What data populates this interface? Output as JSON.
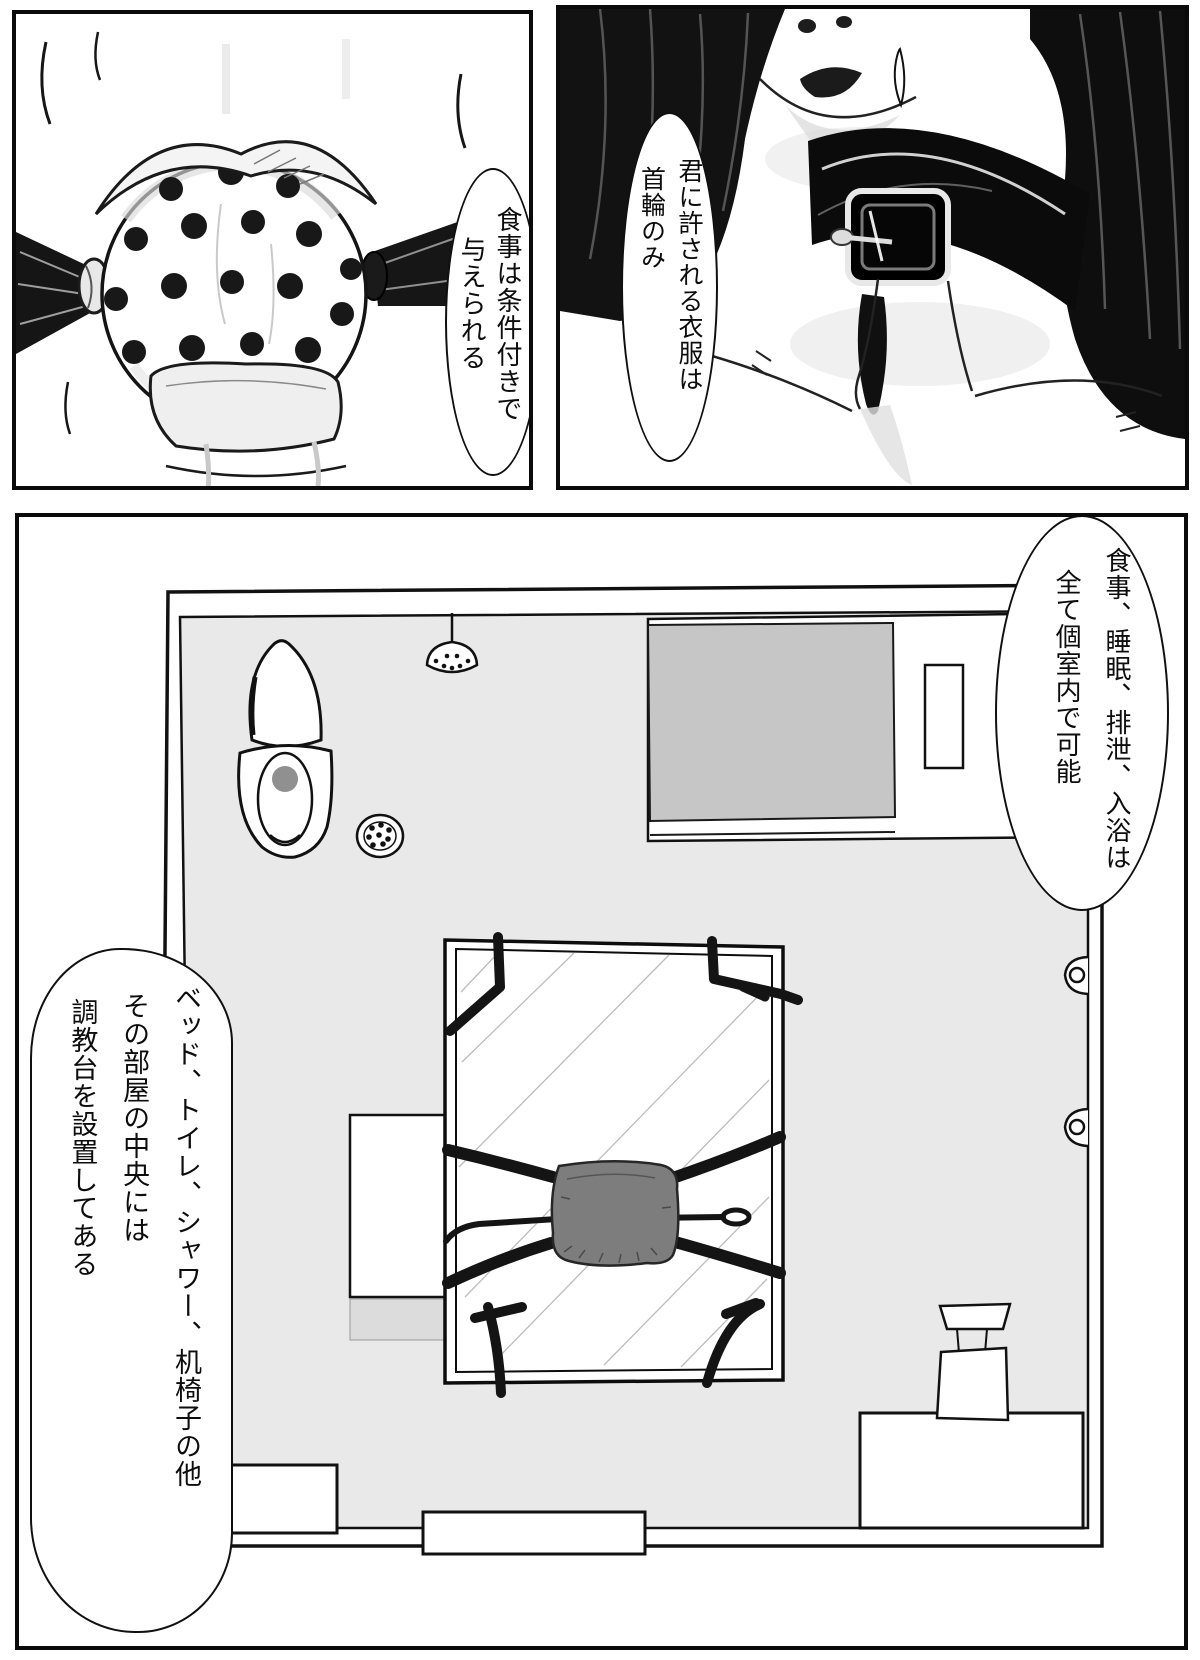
{
  "page": {
    "kind": "comic-page"
  },
  "colors": {
    "ink": "#111111",
    "floor_gray": "#e9e9e9",
    "mattress_gray": "#c6c6c6",
    "cushion_gray": "#7d7d7d",
    "drain_gray": "#909090",
    "shelf_strip_gray": "#dcdcdc"
  },
  "panels": {
    "top_left": {
      "bubble": {
        "lines": [
          "食事は条件付きで",
          "与えられる"
        ]
      }
    },
    "top_right": {
      "bubble": {
        "lines": [
          "君に許される衣服は",
          "首輪のみ"
        ]
      }
    },
    "bottom": {
      "bubble_right": {
        "lines": [
          "食事、睡眠、排泄、入浴は",
          "全て個室内で可能"
        ]
      },
      "bubble_left": {
        "lines": [
          "ベッド、トイレ、シャワー、机椅子の他",
          "その部屋の中央には",
          "調教台を設置してある"
        ]
      }
    }
  }
}
